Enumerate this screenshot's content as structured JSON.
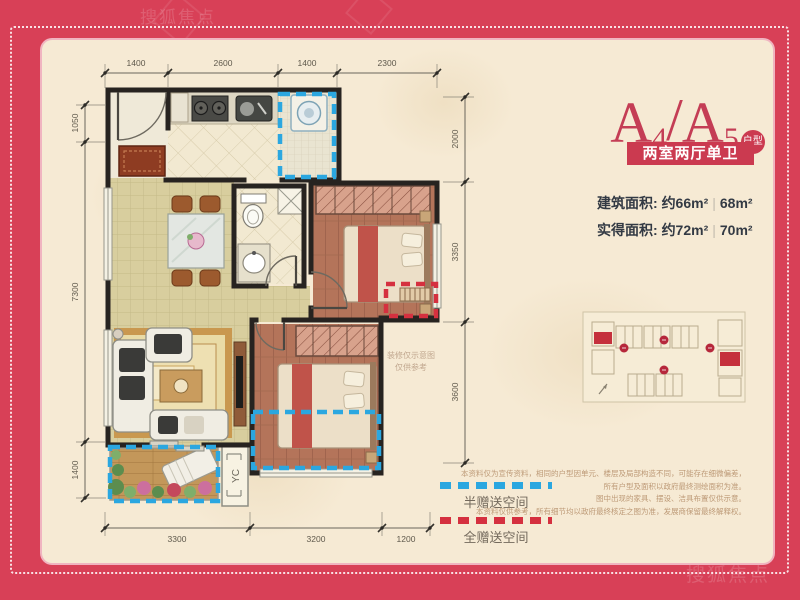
{
  "title": {
    "letter1": "A",
    "digit1": "4",
    "slash": "/",
    "letter2": "A",
    "digit2": "5",
    "badge": "户型",
    "subtitle": "两室两厅单卫"
  },
  "areas": {
    "built": {
      "label": "建筑面积:",
      "value1": "约66m²",
      "divider": "|",
      "value2": "68m²"
    },
    "actual": {
      "label": "实得面积:",
      "value1": "约72m²",
      "divider": "|",
      "value2": "70m²"
    }
  },
  "dimensions": {
    "top": [
      "1400",
      "2600",
      "1400",
      "2300"
    ],
    "left": [
      "1050",
      "7300",
      "1400"
    ],
    "right": [
      "2000",
      "3350",
      "3600"
    ],
    "bottom": [
      "3300",
      "3200",
      "1200"
    ]
  },
  "legend": {
    "half": {
      "label": "半赠送空间",
      "color": "#2ba7e0"
    },
    "full": {
      "label": "全赠送空间",
      "color": "#d5303f"
    }
  },
  "plan": {
    "ac_label": "YC",
    "note_line1": "装修仅示意图",
    "note_line2": "仅供参考"
  },
  "disclaimer": [
    "本资料仅为宣传资料，相同的户型因单元、楼层及局部构造不同，可能存在细微偏差，",
    "所有户型及面积以政府最终测绘面积为准。",
    "图中出现的家具、摆设、洁具布置仅供示意。",
    "本资料仅供参考，所有细节均以政府最终核定之图为准，发展商保留最终解释权。"
  ],
  "watermark": "搜狐焦点",
  "colors": {
    "frame_red": "#d84057",
    "accent_red": "#cb3a50",
    "paper": "#f6ead4",
    "dash_blue": "#2ba7e0",
    "dash_red": "#d5303f"
  }
}
